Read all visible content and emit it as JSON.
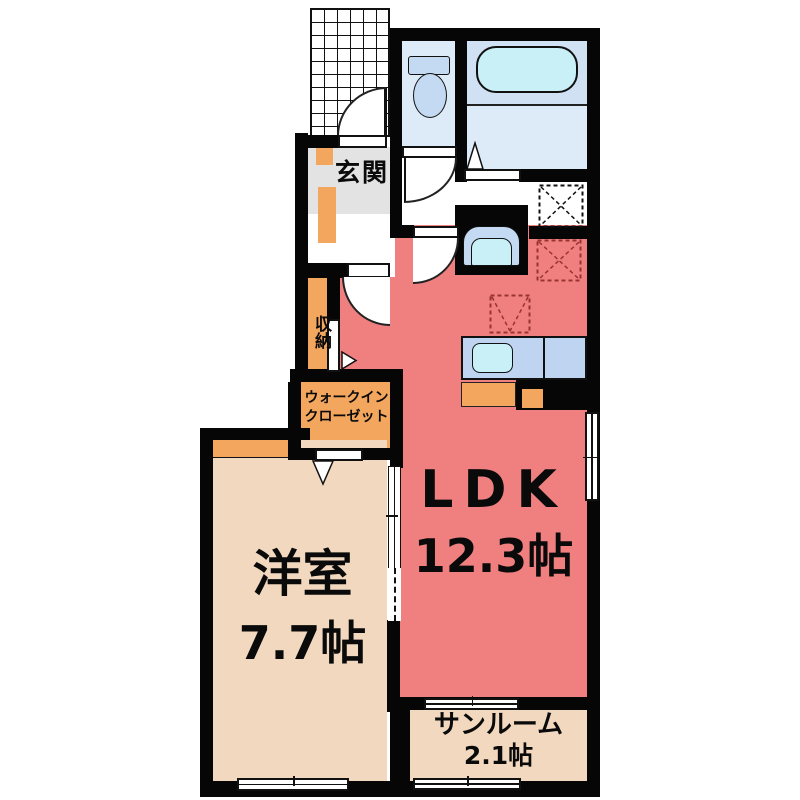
{
  "rooms": {
    "genkan": {
      "label": "玄関"
    },
    "storage": {
      "label": "収納"
    },
    "walk_in_closet": {
      "line1": "ウォークイン",
      "line2": "クローゼット"
    },
    "western_room": {
      "label": "洋室",
      "size": "7.7帖"
    },
    "ldk": {
      "label": "LDK",
      "size": "12.3帖"
    },
    "sunroom": {
      "label": "サンルーム",
      "size": "2.1帖"
    }
  },
  "fixtures": [
    "bathtub",
    "toilet",
    "washbasin",
    "kitchen-counter",
    "kitchen-sink",
    "entrance-porch-grid",
    "washer-space-marker",
    "refrigerator-space-marker",
    "stove-marker"
  ],
  "colors": {
    "ldk_red": "#f08080",
    "room_tan": "#f2d8be",
    "cabinet_orange": "#f3a65e",
    "water_blue": "#dcebf7",
    "fixture_cyan": "#c9eff7",
    "counter_blue": "#bed4f1",
    "wall_black": "#060606",
    "marker_red": "#993333"
  }
}
